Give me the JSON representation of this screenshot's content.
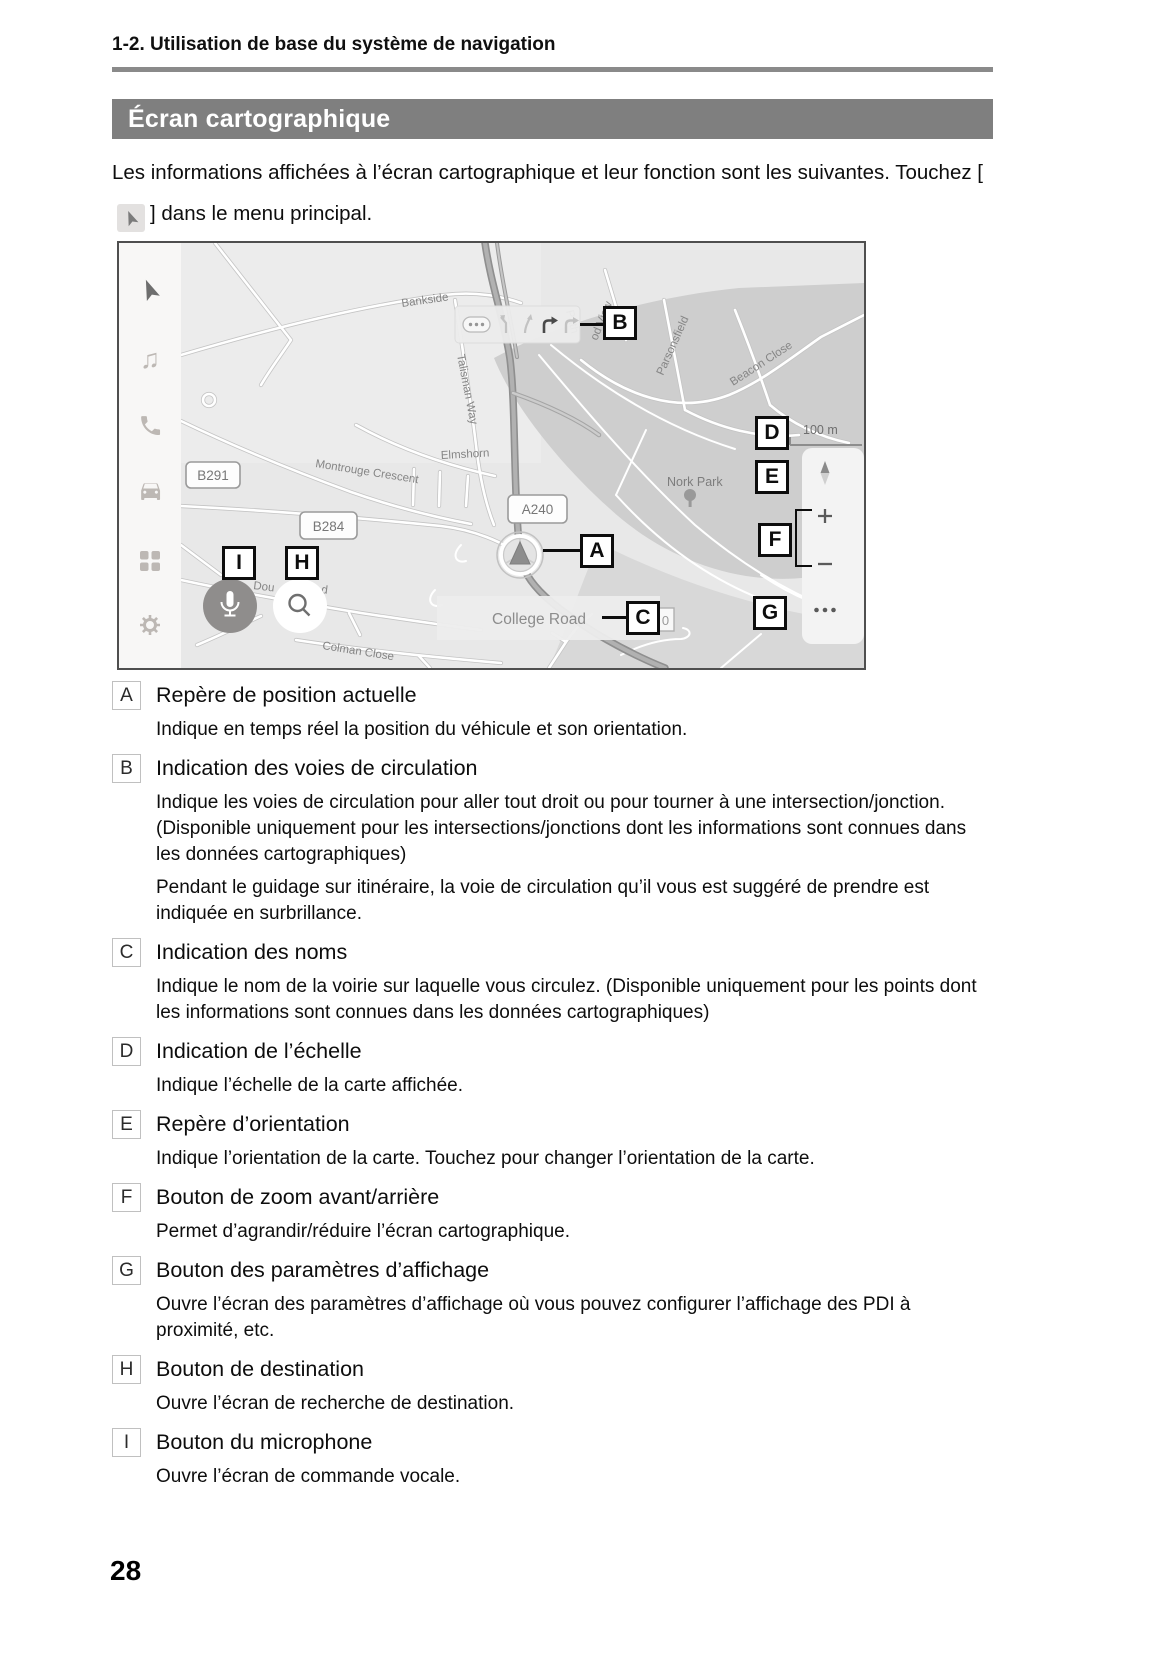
{
  "page": {
    "breadcrumb": "1-2. Utilisation de base du système de navigation",
    "section_title": "Écran cartographique",
    "intro_part1": "Les informations affichées à l’écran cartographique et leur fonction sont les suivantes. Touchez [",
    "intro_part2": "] dans le menu principal.",
    "page_number": "28",
    "colors": {
      "section_bar_bg": "#7f7f7f",
      "rule": "#8a8a8a"
    }
  },
  "map": {
    "callouts": {
      "a": "A",
      "b": "B",
      "c": "C",
      "d": "D",
      "e": "E",
      "f": "F",
      "g": "G",
      "h": "H",
      "i": "I"
    },
    "scale_label": "100 m",
    "zoom_in": "+",
    "zoom_out": "−",
    "current_street": "College Road",
    "counter": "0",
    "badges": {
      "b291": "B291",
      "b284": "B284",
      "a240": "A240"
    },
    "road_labels": {
      "bankside": "Bankside",
      "talisman_way": "Talisman Way",
      "montrouge_crescent": "Montrouge Crescent",
      "elmshorn": "Elmshorn",
      "nork_park": "Nork Park",
      "parsonsfield": "Parsonsfield",
      "beacon_close": "Beacon Close",
      "wood_view": "od View",
      "path": "Path",
      "colman_close": "Colman Close",
      "down_frag1": "Dou",
      "down_frag2": "d"
    },
    "icons": [
      "navigation-arrow",
      "music-note",
      "phone",
      "car",
      "apps-grid",
      "gear",
      "microphone",
      "magnifier",
      "compass",
      "ellipsis"
    ]
  },
  "legend": {
    "items": [
      {
        "key": "A",
        "title": "Repère de position actuelle",
        "paragraphs": [
          "Indique en temps réel la position du véhicule et son orientation."
        ]
      },
      {
        "key": "B",
        "title": "Indication des voies de circulation",
        "paragraphs": [
          "Indique les voies de circulation pour aller tout droit ou pour tourner à une intersection/jonction. (Disponible uniquement pour les intersections/jonctions dont les informations sont connues dans les données cartographiques)",
          "Pendant le guidage sur itinéraire, la voie de circulation qu’il vous est suggéré de prendre est indiquée en surbrillance."
        ]
      },
      {
        "key": "C",
        "title": "Indication des noms",
        "paragraphs": [
          "Indique le nom de la voirie sur laquelle vous circulez. (Disponible uniquement pour les points dont les informations sont connues dans les données cartographiques)"
        ]
      },
      {
        "key": "D",
        "title": "Indication de l’échelle",
        "paragraphs": [
          "Indique l’échelle de la carte affichée."
        ]
      },
      {
        "key": "E",
        "title": "Repère d’orientation",
        "paragraphs": [
          "Indique l’orientation de la carte. Touchez pour changer l’orientation de la carte."
        ]
      },
      {
        "key": "F",
        "title": "Bouton de zoom avant/arrière",
        "paragraphs": [
          "Permet d’agrandir/réduire l’écran cartographique."
        ]
      },
      {
        "key": "G",
        "title": "Bouton des paramètres d’affichage",
        "paragraphs": [
          "Ouvre l’écran des paramètres d’affichage où vous pouvez configurer l’affichage des PDI à proximité, etc."
        ]
      },
      {
        "key": "H",
        "title": "Bouton de destination",
        "paragraphs": [
          "Ouvre l’écran de recherche de destination."
        ]
      },
      {
        "key": "I",
        "title": "Bouton du microphone",
        "paragraphs": [
          "Ouvre l’écran de commande vocale."
        ]
      }
    ]
  }
}
